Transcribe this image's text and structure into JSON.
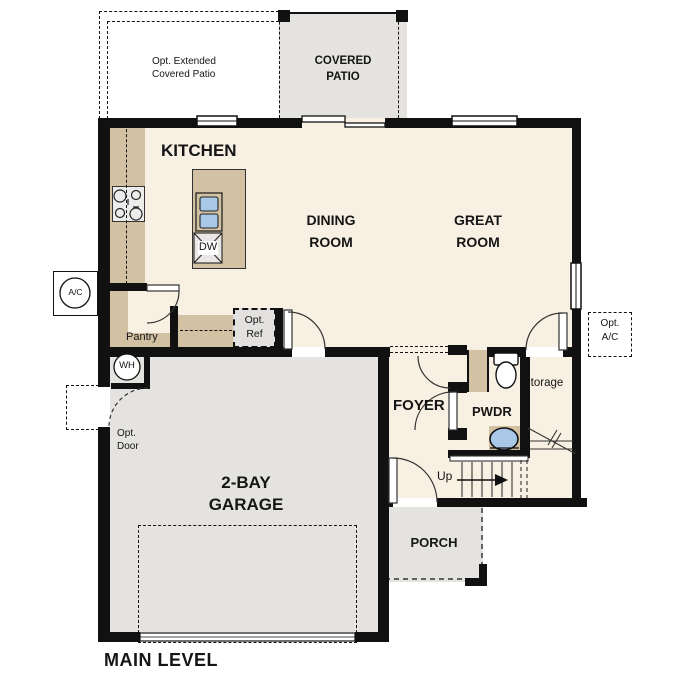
{
  "title": "MAIN LEVEL",
  "rooms": {
    "kitchen": "KITCHEN",
    "dining": "DINING\nROOM",
    "great": "GREAT\nROOM",
    "garage": "2-BAY\nGARAGE",
    "foyer": "FOYER",
    "pwdr": "PWDR",
    "porch": "PORCH",
    "storage": "Storage",
    "pantry": "Pantry",
    "covered_patio": "COVERED\nPATIO"
  },
  "options": {
    "extended_patio": "Opt. Extended\nCovered Patio",
    "ref": "Opt.\nRef",
    "door": "Opt.\nDoor",
    "ac": "Opt.\nA/C"
  },
  "equipment": {
    "ac_unit": "A/C",
    "water_heater": "WH",
    "dishwasher": "DW"
  },
  "stairs": {
    "direction": "Up"
  },
  "colors": {
    "floor": "#f8f0e2",
    "cabinet": "#d2c1a3",
    "concrete": "#e4e3e0",
    "wall": "#111111",
    "fixture_blue": "#a9c7e6"
  }
}
